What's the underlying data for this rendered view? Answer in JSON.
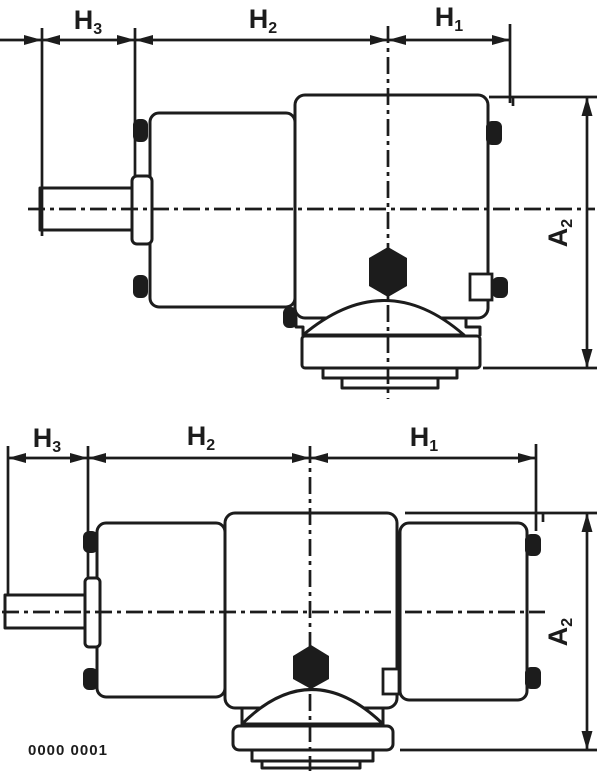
{
  "colors": {
    "ink": "#1c1c1c",
    "paper": "#ffffff"
  },
  "caption": "0000 0001",
  "figures": {
    "top": {
      "dim_labels": {
        "h3": {
          "base": "H",
          "sub": "3"
        },
        "h2": {
          "base": "H",
          "sub": "2"
        },
        "h1": {
          "base": "H",
          "sub": "1"
        },
        "a2": {
          "base": "A",
          "sub": "2"
        }
      }
    },
    "bottom": {
      "dim_labels": {
        "h3": {
          "base": "H",
          "sub": "3"
        },
        "h2": {
          "base": "H",
          "sub": "2"
        },
        "h1": {
          "base": "H",
          "sub": "1"
        },
        "a2": {
          "base": "A",
          "sub": "2"
        }
      }
    }
  }
}
